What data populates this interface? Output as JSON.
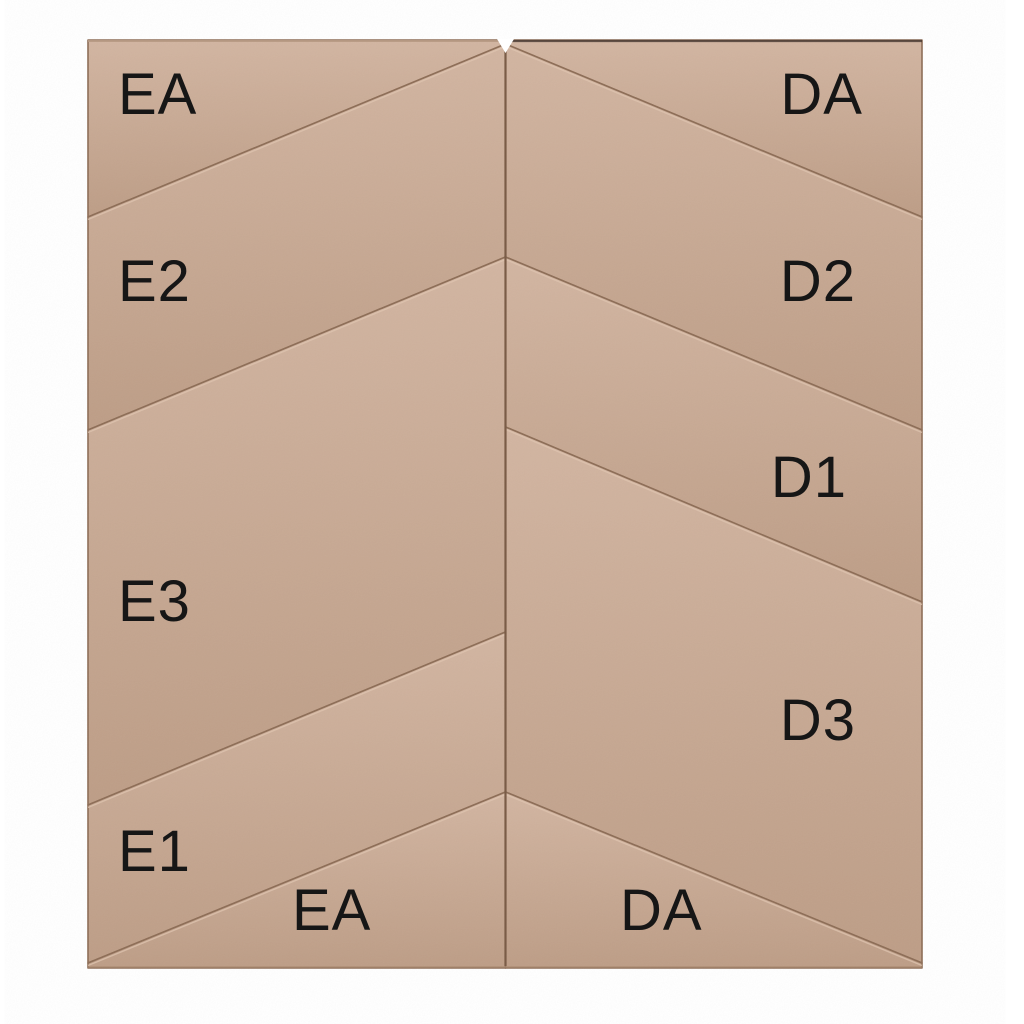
{
  "panel": {
    "description": "chevron-upholstered-wall-panel-layout",
    "colors": {
      "background": "#ffffff",
      "tile_light": "#d2b5a1",
      "tile_dark": "#bd9d86",
      "seam": "#8d6d56",
      "highlight": "#e0c5b0",
      "label": "#161616",
      "center_seam": "#7a5c47"
    },
    "frame": {
      "x": 88,
      "y": 40,
      "w": 834,
      "h": 928
    },
    "label_style": {
      "size": 58,
      "letter_spacing": 1
    },
    "center_seam": {
      "x": 505.5,
      "y1": 44,
      "y2": 966,
      "width": 2.2
    },
    "top_notch": {
      "points": [
        [
          497,
          39
        ],
        [
          514,
          39
        ],
        [
          505.5,
          53
        ]
      ]
    },
    "edge_lines": [
      {
        "x1": 88,
        "y1": 41,
        "x2": 504,
        "y2": 41,
        "color": "#b79a84",
        "width": 2,
        "opacity": 0.9
      },
      {
        "x1": 507,
        "y1": 41,
        "x2": 922,
        "y2": 41,
        "color": "#463831",
        "width": 2.2,
        "opacity": 0.8
      },
      {
        "x1": 88,
        "y1": 967,
        "x2": 922,
        "y2": 967,
        "color": "#a98970",
        "width": 1.5,
        "opacity": 0.7
      }
    ],
    "tiles": [
      {
        "id": "EA-top",
        "highlight": false,
        "points": [
          [
            88,
            40
          ],
          [
            505.5,
            40
          ],
          [
            505.5,
            44
          ],
          [
            88,
            217
          ]
        ],
        "label": {
          "text": "EA",
          "x": 118,
          "y": 114,
          "anchor": "start"
        }
      },
      {
        "id": "E2",
        "highlight": true,
        "points": [
          [
            88,
            217
          ],
          [
            505.5,
            44
          ],
          [
            505.5,
            257
          ],
          [
            88,
            430
          ]
        ],
        "label": {
          "text": "E2",
          "x": 118,
          "y": 301,
          "anchor": "start"
        }
      },
      {
        "id": "E3",
        "highlight": true,
        "points": [
          [
            88,
            430
          ],
          [
            505.5,
            257
          ],
          [
            505.5,
            632
          ],
          [
            88,
            805
          ]
        ],
        "label": {
          "text": "E3",
          "x": 118,
          "y": 621,
          "anchor": "start"
        }
      },
      {
        "id": "E1",
        "highlight": true,
        "points": [
          [
            88,
            805
          ],
          [
            505.5,
            632
          ],
          [
            505.5,
            792
          ],
          [
            88,
            963
          ]
        ],
        "label": {
          "text": "E1",
          "x": 118,
          "y": 871,
          "anchor": "start"
        }
      },
      {
        "id": "EA-bottom",
        "highlight": true,
        "points": [
          [
            88,
            963
          ],
          [
            505.5,
            792
          ],
          [
            505.5,
            968
          ],
          [
            88,
            968
          ]
        ],
        "label": {
          "text": "EA",
          "x": 292,
          "y": 930,
          "anchor": "start"
        }
      },
      {
        "id": "DA-top",
        "highlight": false,
        "points": [
          [
            505.5,
            40
          ],
          [
            922,
            40
          ],
          [
            922,
            217
          ],
          [
            505.5,
            44
          ]
        ],
        "label": {
          "text": "DA",
          "x": 863,
          "y": 114,
          "anchor": "end"
        }
      },
      {
        "id": "D2",
        "highlight": true,
        "points": [
          [
            505.5,
            44
          ],
          [
            922,
            217
          ],
          [
            922,
            430
          ],
          [
            505.5,
            257
          ]
        ],
        "label": {
          "text": "D2",
          "x": 856,
          "y": 301,
          "anchor": "end"
        }
      },
      {
        "id": "D1",
        "highlight": true,
        "points": [
          [
            505.5,
            257
          ],
          [
            922,
            430
          ],
          [
            922,
            602
          ],
          [
            505.5,
            427
          ]
        ],
        "label": {
          "text": "D1",
          "x": 847,
          "y": 497,
          "anchor": "end"
        }
      },
      {
        "id": "D3",
        "highlight": true,
        "points": [
          [
            505.5,
            427
          ],
          [
            922,
            602
          ],
          [
            922,
            963
          ],
          [
            505.5,
            792
          ]
        ],
        "label": {
          "text": "D3",
          "x": 856,
          "y": 740,
          "anchor": "end"
        }
      },
      {
        "id": "DA-bottom",
        "highlight": true,
        "points": [
          [
            505.5,
            792
          ],
          [
            922,
            963
          ],
          [
            922,
            968
          ],
          [
            505.5,
            968
          ]
        ],
        "label": {
          "text": "DA",
          "x": 620,
          "y": 930,
          "anchor": "start"
        }
      }
    ]
  }
}
